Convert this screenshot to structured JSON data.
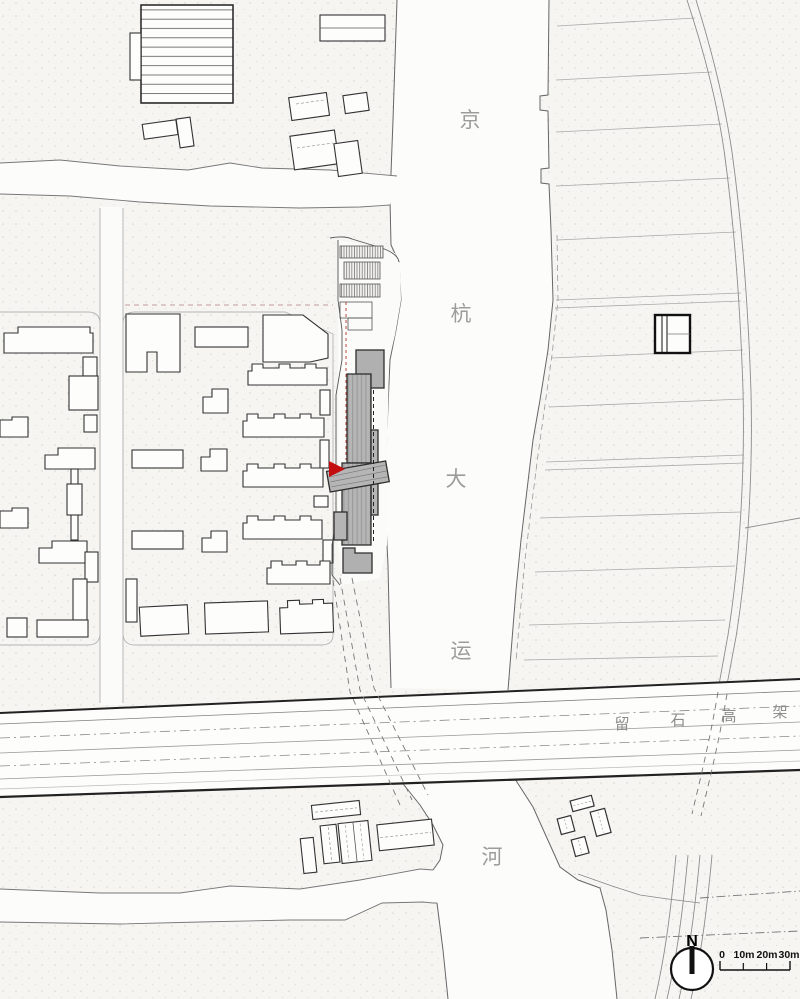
{
  "labels": {
    "canal": {
      "chars": [
        "京",
        "杭",
        "大",
        "运",
        "河"
      ]
    },
    "highway": {
      "chars": [
        "留",
        "石",
        "高",
        "架"
      ]
    }
  },
  "compass": {
    "north": "N"
  },
  "scale_bar": {
    "ticks": [
      "0",
      "10m",
      "20m",
      "30m"
    ]
  },
  "colors": {
    "paper": "#f6f5f2",
    "water": "#fcfcfb",
    "accent_red": "#c40d0e",
    "boundary_red_dash": "#b34a3f",
    "building_gray_fill": "#b5b5b5",
    "building_dark_stroke": "#2e2e2e",
    "outline_gray": "#333333",
    "canal_label_gray": "#9c9c9c",
    "highway_label_gray": "#8d8d8d"
  }
}
